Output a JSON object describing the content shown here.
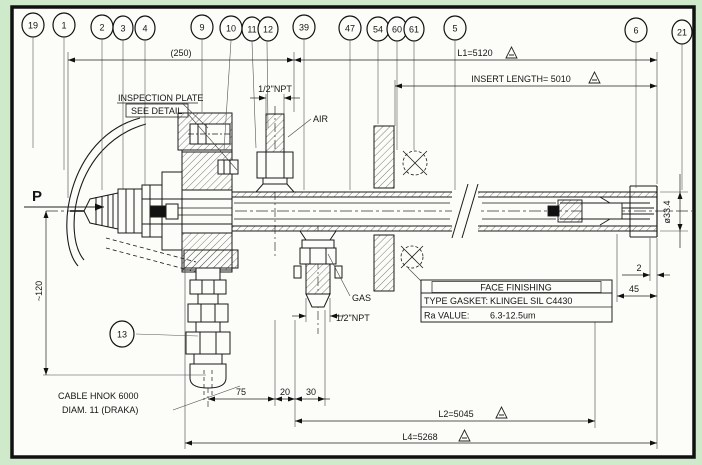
{
  "colors": {
    "background": "#cfe9cb",
    "paper": "#fcfcf8",
    "ink": "#1a1a1a",
    "frame": "#111111"
  },
  "balloons": [
    "19",
    "1",
    "2",
    "3",
    "4",
    "9",
    "10",
    "11",
    "12",
    "39",
    "47",
    "54",
    "60",
    "61",
    "5",
    "6",
    "21",
    "13"
  ],
  "dims": {
    "overall": "(250)",
    "l1": "L1=5120",
    "insert": "INSERT LENGTH= 5010",
    "l2": "L2=5045",
    "l4": "L4=5268",
    "w75": "75",
    "w20": "20",
    "w30": "30",
    "h120": "~120",
    "dia": "ø33.4",
    "t2": "2",
    "w45": "45"
  },
  "labels": {
    "inspection_plate": "INSPECTION PLATE",
    "see_detail": "SEE DETAIL",
    "npt_air": "1/2\"NPT",
    "air": "AIR",
    "gas": "GAS",
    "npt_gas": "1/2\"NPT",
    "p": "P",
    "cable_line1": "CABLE HNOK 6000",
    "cable_line2": "DIAM. 11 (DRAKA)"
  },
  "table": {
    "title": "FACE FINISHING",
    "gasket_label": "TYPE GASKET:",
    "gasket_value": "KLINGEL SIL C4430",
    "ra_label": "Ra VALUE:",
    "ra_value": "6.3-12.5um"
  }
}
